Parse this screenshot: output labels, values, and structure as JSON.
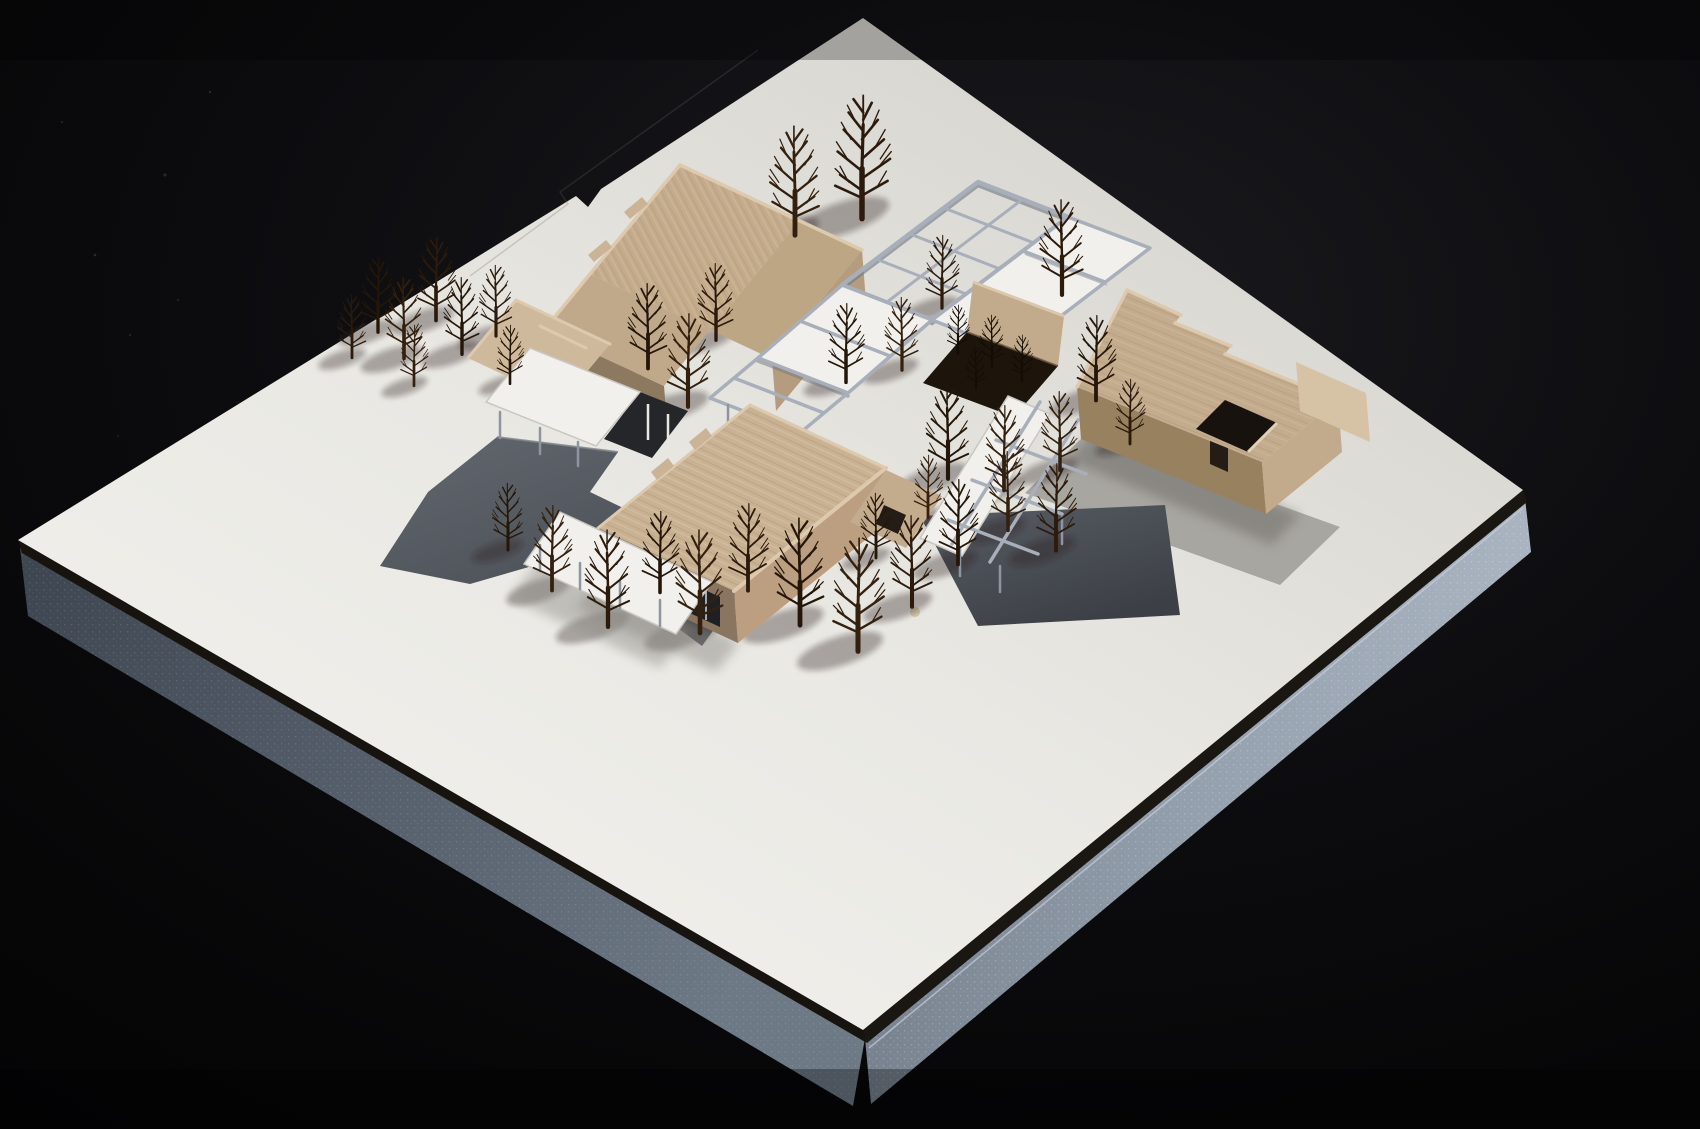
{
  "meta": {
    "type": "photograph",
    "subject": "Architectural scale model photographed from an elevated three-quarter view",
    "backdrop": "black studio background",
    "base": "white museum board mounted on blue-gray foam slab"
  },
  "palette": {
    "background": "#09090b",
    "board_top": "#e9e8e3",
    "board_bright": "#f2f1ed",
    "board_shaded": "#d6d4ce",
    "board_edge_line": "#17140f",
    "foam_dark": "#46505c",
    "foam_light": "#939eac",
    "wood": "#c7af92",
    "wood_light": "#dbc8ac",
    "wood_dark": "#8d7860",
    "pergola_steel": "#a8afba",
    "sunken_path_gray": "#555a61",
    "dark_court_gray": "#4e535a",
    "east_court_gray": "#a8a6a1",
    "canopy_white": "#f3f2ee",
    "glazing_dark": "#1e2024",
    "tree_brown": "#2a1a0e",
    "shadow": "rgba(42,36,28,0.34)"
  },
  "scene": {
    "board_corners": [
      [
        863,
        18
      ],
      [
        1523,
        490
      ],
      [
        863,
        1030
      ],
      [
        18,
        540
      ]
    ],
    "buildings": [
      {
        "id": "northwest-block",
        "material": "basswood",
        "features": "stepped parapet roof, roof bulkheads, lower west wing, white entry canopy over sunken void"
      },
      {
        "id": "south-block",
        "material": "basswood",
        "features": "long grained roof, stepped parapets, glazed base, white canopy on thin columns"
      },
      {
        "id": "east-block",
        "material": "basswood",
        "features": "stepped parapet, tall east end wall, open roof courtyard, gray paved court"
      }
    ],
    "pergola": {
      "material": "steel-gray open frame grid with white covered panels",
      "arms": [
        "north open grid",
        "covered center",
        "west link to south block",
        "south walkway over dark garden court"
      ]
    },
    "site_features": {
      "sunken_path": "dark gray L-shaped sunken path, west side",
      "central_planter": "dark planted courtyard with shrub trees and wood planter wall",
      "south_court": "dark gray sunken garden crossed by white walkway",
      "east_court": "light gray paved court",
      "paper_speck": [
        915,
        612
      ]
    },
    "trees": {
      "count": 36,
      "positions": [
        [
          352,
          356,
          62
        ],
        [
          378,
          330,
          74
        ],
        [
          404,
          356,
          80
        ],
        [
          436,
          318,
          82
        ],
        [
          462,
          352,
          76
        ],
        [
          414,
          384,
          60
        ],
        [
          496,
          334,
          70
        ],
        [
          510,
          382,
          58
        ],
        [
          795,
          232,
          108
        ],
        [
          862,
          215,
          122
        ],
        [
          648,
          366,
          84
        ],
        [
          688,
          404,
          92
        ],
        [
          716,
          338,
          76
        ],
        [
          846,
          380,
          78
        ],
        [
          902,
          368,
          72
        ],
        [
          942,
          306,
          72
        ],
        [
          948,
          476,
          92
        ],
        [
          1004,
          488,
          84
        ],
        [
          1062,
          292,
          94
        ],
        [
          1096,
          398,
          84
        ],
        [
          1060,
          468,
          78
        ],
        [
          1130,
          442,
          64
        ],
        [
          508,
          548,
          66
        ],
        [
          552,
          588,
          84
        ],
        [
          608,
          624,
          96
        ],
        [
          660,
          590,
          80
        ],
        [
          700,
          630,
          102
        ],
        [
          748,
          588,
          86
        ],
        [
          800,
          622,
          106
        ],
        [
          858,
          648,
          112
        ],
        [
          912,
          604,
          90
        ],
        [
          958,
          562,
          84
        ],
        [
          1008,
          528,
          78
        ],
        [
          1056,
          548,
          86
        ],
        [
          876,
          556,
          64
        ],
        [
          928,
          516,
          62
        ]
      ]
    },
    "planter_shrubs": {
      "count": 4,
      "positions": [
        [
          958,
          352,
          48
        ],
        [
          992,
          366,
          52
        ],
        [
          1022,
          380,
          46
        ],
        [
          976,
          388,
          42
        ]
      ]
    }
  }
}
